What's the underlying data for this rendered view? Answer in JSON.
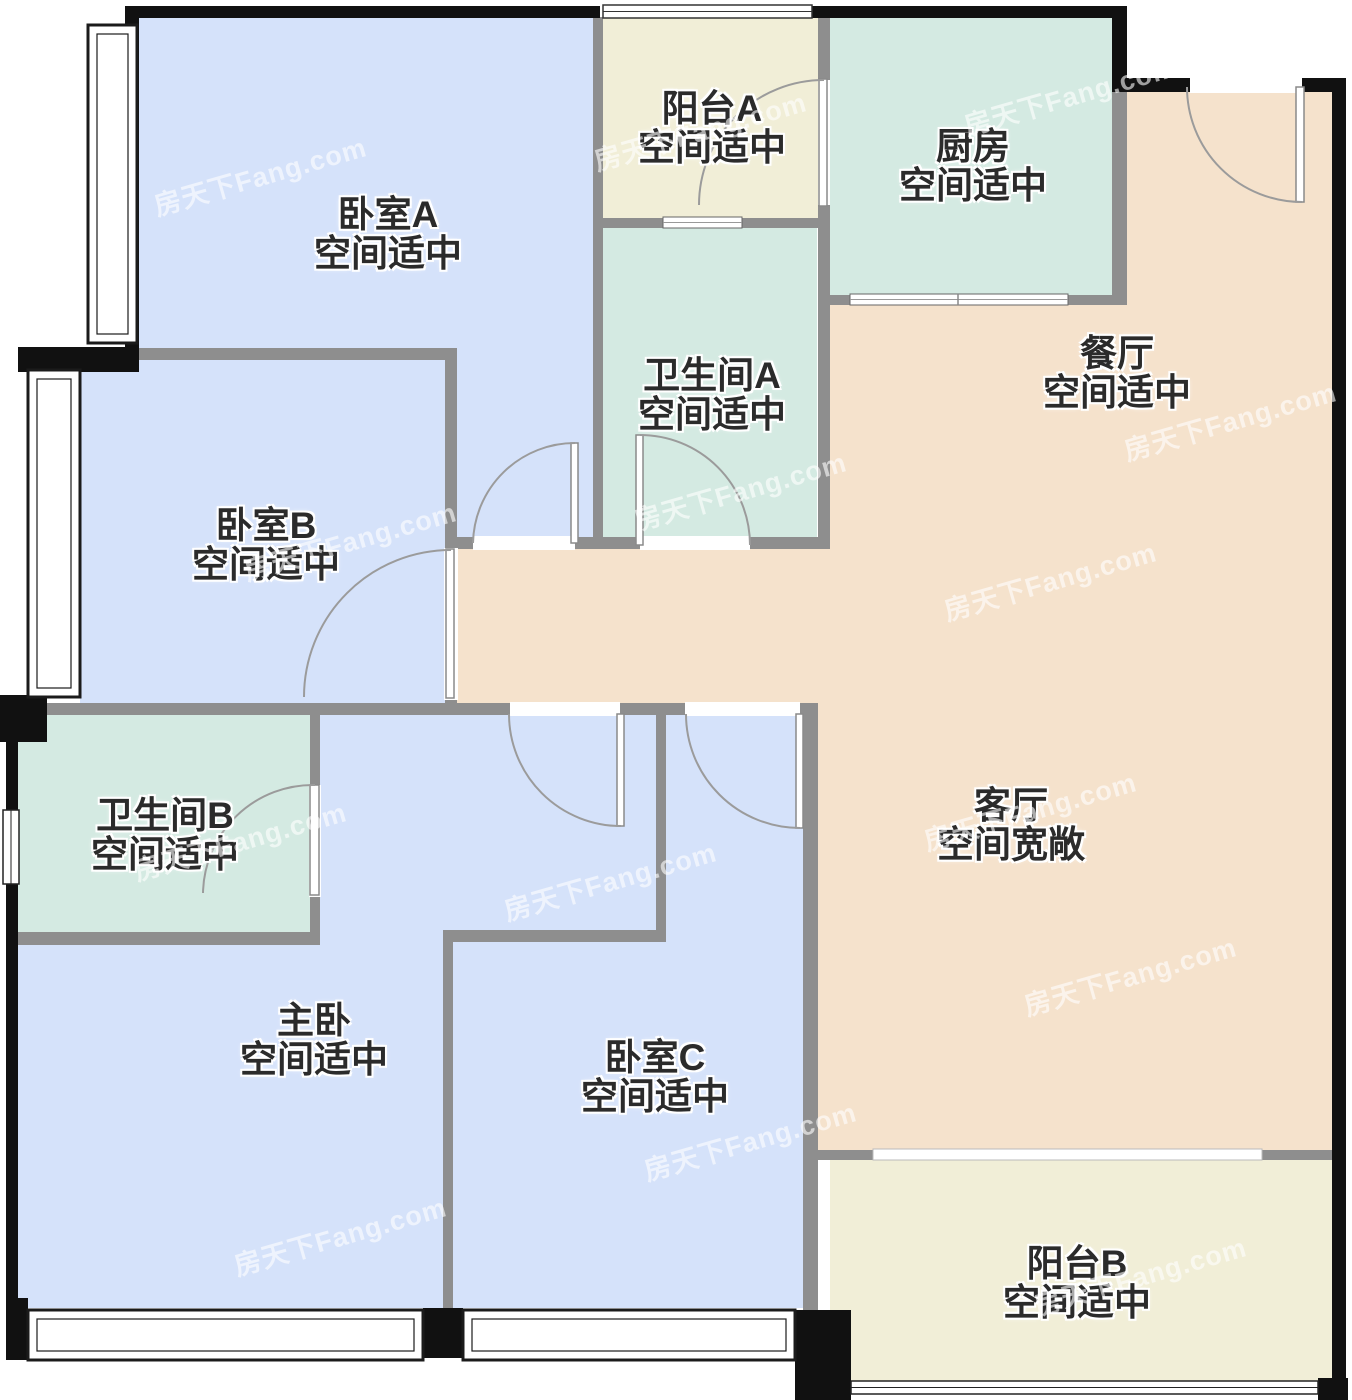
{
  "watermark": {
    "text": "房天下Fang.com"
  },
  "colors": {
    "bedroom_fill": "#d5e2fa",
    "bath_fill": "#d4eae2",
    "balcony_fill": "#f1eed7",
    "living_fill": "#f5e2cc",
    "wall_gray": "#8e8e8e",
    "wall_black": "#111111",
    "door_arc": "#9b9b9b"
  },
  "rooms": [
    {
      "id": "bedroom-a",
      "name": "卧室A",
      "note": "空间适中"
    },
    {
      "id": "balcony-a",
      "name": "阳台A",
      "note": "空间适中"
    },
    {
      "id": "kitchen",
      "name": "厨房",
      "note": "空间适中"
    },
    {
      "id": "bathroom-a",
      "name": "卫生间A",
      "note": "空间适中"
    },
    {
      "id": "dining",
      "name": "餐厅",
      "note": "空间适中"
    },
    {
      "id": "bedroom-b",
      "name": "卧室B",
      "note": "空间适中"
    },
    {
      "id": "bathroom-b",
      "name": "卫生间B",
      "note": "空间适中"
    },
    {
      "id": "living",
      "name": "客厅",
      "note": "空间宽敞"
    },
    {
      "id": "master",
      "name": "主卧",
      "note": "空间适中"
    },
    {
      "id": "bedroom-c",
      "name": "卧室C",
      "note": "空间适中"
    },
    {
      "id": "balcony-b",
      "name": "阳台B",
      "note": "空间适中"
    }
  ]
}
